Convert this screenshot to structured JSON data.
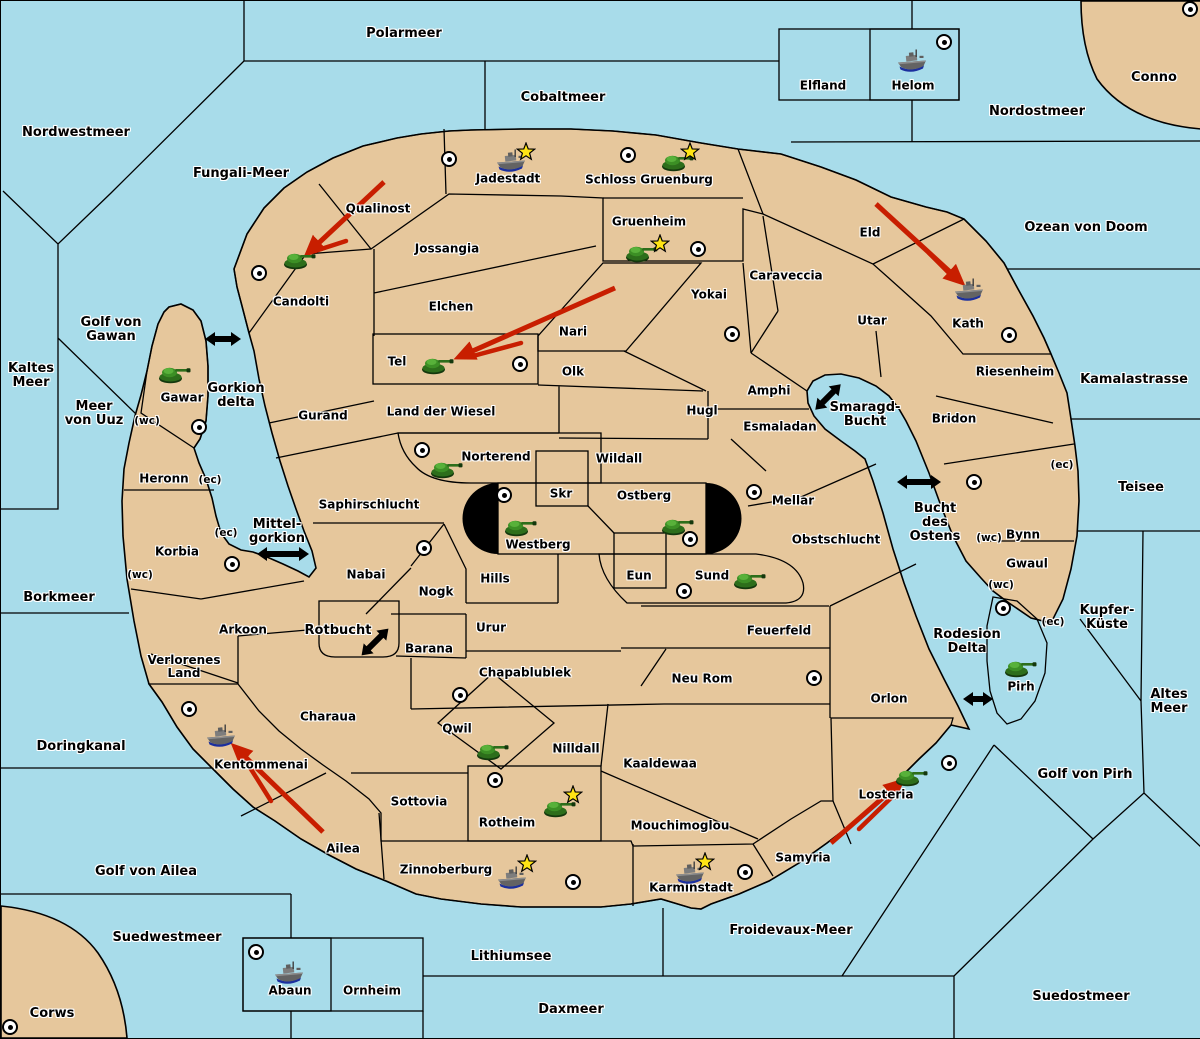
{
  "title": "Fantasy conquest map",
  "colors": {
    "sea": "#a8dcea",
    "land": "#e6c79c",
    "green": "#a3c49a",
    "red": "#c0897f",
    "gray": "#8b8b8b",
    "black_zone": "#000000",
    "arrow_red": "#c81e00",
    "star": "#ffe414"
  },
  "sea_zones": [
    {
      "name": "Polarmeer",
      "x": 403,
      "y": 33
    },
    {
      "name": "Nordwestmeer",
      "x": 75,
      "y": 132
    },
    {
      "name": "Fungali-Meer",
      "x": 240,
      "y": 173
    },
    {
      "name": "Cobaltmeer",
      "x": 562,
      "y": 97
    },
    {
      "name": "Nordostmeer",
      "x": 1036,
      "y": 111
    },
    {
      "name": "Ozean von Doom",
      "x": 1085,
      "y": 227
    },
    {
      "name": "Kaltes\nMeer",
      "x": 30,
      "y": 375
    },
    {
      "name": "Golf von\nGawan",
      "x": 110,
      "y": 329
    },
    {
      "name": "Meer\nvon Uuz",
      "x": 93,
      "y": 413
    },
    {
      "name": "Gorkion\ndelta",
      "x": 235,
      "y": 395
    },
    {
      "name": "Mittel-\ngorkion",
      "x": 276,
      "y": 531
    },
    {
      "name": "Borkmeer",
      "x": 58,
      "y": 597
    },
    {
      "name": "Doringkanal",
      "x": 80,
      "y": 746
    },
    {
      "name": "Golf von Ailea",
      "x": 145,
      "y": 871
    },
    {
      "name": "Suedwestmeer",
      "x": 166,
      "y": 937
    },
    {
      "name": "Corws",
      "x": 51,
      "y": 1013
    },
    {
      "name": "Lithiumsee",
      "x": 510,
      "y": 956
    },
    {
      "name": "Daxmeer",
      "x": 570,
      "y": 1009
    },
    {
      "name": "Froidevaux-Meer",
      "x": 790,
      "y": 930
    },
    {
      "name": "Suedostmeer",
      "x": 1080,
      "y": 996
    },
    {
      "name": "Golf von Pirh",
      "x": 1084,
      "y": 774
    },
    {
      "name": "Altes\nMeer",
      "x": 1168,
      "y": 701
    },
    {
      "name": "Kupfer-\nKüste",
      "x": 1106,
      "y": 617
    },
    {
      "name": "Teisee",
      "x": 1140,
      "y": 487
    },
    {
      "name": "Kamalastrasse",
      "x": 1133,
      "y": 379
    },
    {
      "name": "Conno",
      "x": 1153,
      "y": 77
    },
    {
      "name": "Rotbucht",
      "x": 337,
      "y": 630
    },
    {
      "name": "Smaragd-\nBucht",
      "x": 864,
      "y": 414
    },
    {
      "name": "Bucht\ndes\nOstens",
      "x": 934,
      "y": 522
    },
    {
      "name": "Rodesion\nDelta",
      "x": 966,
      "y": 641
    }
  ],
  "territories": [
    {
      "name": "Jadestadt",
      "x": 507,
      "y": 178
    },
    {
      "name": "Schloss Gruenburg",
      "x": 648,
      "y": 179
    },
    {
      "name": "Gruenheim",
      "x": 648,
      "y": 221
    },
    {
      "name": "Qualinost",
      "x": 377,
      "y": 208
    },
    {
      "name": "Candolti",
      "x": 300,
      "y": 301
    },
    {
      "name": "Jossangia",
      "x": 446,
      "y": 248
    },
    {
      "name": "Elchen",
      "x": 450,
      "y": 306
    },
    {
      "name": "Nari",
      "x": 572,
      "y": 331
    },
    {
      "name": "Tel",
      "x": 396,
      "y": 361
    },
    {
      "name": "Olk",
      "x": 572,
      "y": 371
    },
    {
      "name": "Yokai",
      "x": 708,
      "y": 294
    },
    {
      "name": "Eld",
      "x": 869,
      "y": 232
    },
    {
      "name": "Caraveccia",
      "x": 785,
      "y": 275
    },
    {
      "name": "Utar",
      "x": 871,
      "y": 320
    },
    {
      "name": "Kath",
      "x": 967,
      "y": 323
    },
    {
      "name": "Riesenheim",
      "x": 1014,
      "y": 371
    },
    {
      "name": "Bridon",
      "x": 953,
      "y": 418
    },
    {
      "name": "Gurand",
      "x": 322,
      "y": 415
    },
    {
      "name": "Land der Wiesel",
      "x": 440,
      "y": 411
    },
    {
      "name": "Hugl",
      "x": 701,
      "y": 410
    },
    {
      "name": "Amphi",
      "x": 768,
      "y": 390
    },
    {
      "name": "Esmaladan",
      "x": 779,
      "y": 426
    },
    {
      "name": "Norterend",
      "x": 495,
      "y": 456
    },
    {
      "name": "Wildall",
      "x": 618,
      "y": 458
    },
    {
      "name": "Skr",
      "x": 560,
      "y": 493
    },
    {
      "name": "Ostberg",
      "x": 643,
      "y": 495
    },
    {
      "name": "Westberg",
      "x": 537,
      "y": 544
    },
    {
      "name": "Mellar",
      "x": 792,
      "y": 500
    },
    {
      "name": "Obstschlucht",
      "x": 835,
      "y": 539
    },
    {
      "name": "Eun",
      "x": 638,
      "y": 575
    },
    {
      "name": "Sund",
      "x": 711,
      "y": 575
    },
    {
      "name": "Hills",
      "x": 494,
      "y": 578
    },
    {
      "name": "Nogk",
      "x": 435,
      "y": 591
    },
    {
      "name": "Urur",
      "x": 490,
      "y": 627
    },
    {
      "name": "Saphirschlucht",
      "x": 368,
      "y": 504
    },
    {
      "name": "Nabai",
      "x": 365,
      "y": 574
    },
    {
      "name": "Barana",
      "x": 428,
      "y": 648
    },
    {
      "name": "Chapablublek",
      "x": 524,
      "y": 672
    },
    {
      "name": "Feuerfeld",
      "x": 778,
      "y": 630
    },
    {
      "name": "Neu Rom",
      "x": 701,
      "y": 678
    },
    {
      "name": "Orlon",
      "x": 888,
      "y": 698
    },
    {
      "name": "Arkoon",
      "x": 242,
      "y": 629
    },
    {
      "name": "Verlorenes\nLand",
      "x": 183,
      "y": 666
    },
    {
      "name": "Charaua",
      "x": 327,
      "y": 716
    },
    {
      "name": "Kentommenai",
      "x": 260,
      "y": 764
    },
    {
      "name": "Ailea",
      "x": 342,
      "y": 848
    },
    {
      "name": "Sottovia",
      "x": 418,
      "y": 801
    },
    {
      "name": "Qwil",
      "x": 456,
      "y": 728
    },
    {
      "name": "Nilldall",
      "x": 575,
      "y": 748
    },
    {
      "name": "Kaaldewaa",
      "x": 659,
      "y": 763
    },
    {
      "name": "Rotheim",
      "x": 506,
      "y": 822
    },
    {
      "name": "Mouchimoglou",
      "x": 679,
      "y": 825
    },
    {
      "name": "Zinnoberburg",
      "x": 445,
      "y": 869
    },
    {
      "name": "Karminstadt",
      "x": 690,
      "y": 887
    },
    {
      "name": "Samyria",
      "x": 802,
      "y": 857
    },
    {
      "name": "Losteria",
      "x": 885,
      "y": 794
    },
    {
      "name": "Gawar",
      "x": 181,
      "y": 397
    },
    {
      "name": "Heronn",
      "x": 163,
      "y": 478
    },
    {
      "name": "Korbia",
      "x": 176,
      "y": 551
    },
    {
      "name": "Bynn",
      "x": 1022,
      "y": 534
    },
    {
      "name": "Gwaul",
      "x": 1026,
      "y": 563
    },
    {
      "name": "Pirh",
      "x": 1020,
      "y": 686
    },
    {
      "name": "Elfland",
      "x": 822,
      "y": 85
    },
    {
      "name": "Helom",
      "x": 912,
      "y": 85
    },
    {
      "name": "Abaun",
      "x": 289,
      "y": 990
    },
    {
      "name": "Ornheim",
      "x": 371,
      "y": 990
    }
  ],
  "port_markers": [
    {
      "label": "(wc)",
      "x": 146,
      "y": 420
    },
    {
      "label": "(ec)",
      "x": 209,
      "y": 479
    },
    {
      "label": "(ec)",
      "x": 225,
      "y": 532
    },
    {
      "label": "(wc)",
      "x": 139,
      "y": 574
    },
    {
      "label": "(ec)",
      "x": 1061,
      "y": 464
    },
    {
      "label": "(wc)",
      "x": 988,
      "y": 537
    },
    {
      "label": "(wc)",
      "x": 1000,
      "y": 584
    },
    {
      "label": "(ec)",
      "x": 1052,
      "y": 621
    }
  ],
  "capitals": [
    {
      "territory": "Jadestadt",
      "x": 448,
      "y": 158
    },
    {
      "territory": "Schloss Gruenburg",
      "x": 627,
      "y": 154
    },
    {
      "territory": "Gruenheim",
      "x": 697,
      "y": 248
    },
    {
      "territory": "Candolti",
      "x": 258,
      "y": 272
    },
    {
      "territory": "Conno",
      "x": 1189,
      "y": 8
    },
    {
      "territory": "Helom",
      "x": 943,
      "y": 41
    },
    {
      "territory": "Kath",
      "x": 1008,
      "y": 334
    },
    {
      "territory": "Yokai",
      "x": 731,
      "y": 333
    },
    {
      "territory": "Tel",
      "x": 519,
      "y": 363
    },
    {
      "territory": "Gawar",
      "x": 198,
      "y": 426
    },
    {
      "territory": "Norterend",
      "x": 421,
      "y": 449
    },
    {
      "territory": "Westberg",
      "x": 503,
      "y": 494
    },
    {
      "territory": "Ostberg",
      "x": 689,
      "y": 538
    },
    {
      "territory": "Mellar",
      "x": 753,
      "y": 491
    },
    {
      "territory": "Sund",
      "x": 683,
      "y": 590
    },
    {
      "territory": "Nabai",
      "x": 423,
      "y": 547
    },
    {
      "territory": "Korbia",
      "x": 231,
      "y": 563
    },
    {
      "territory": "Bynn",
      "x": 973,
      "y": 481
    },
    {
      "territory": "Pirh",
      "x": 1002,
      "y": 607
    },
    {
      "territory": "Neu Rom",
      "x": 813,
      "y": 677
    },
    {
      "territory": "Qwil",
      "x": 459,
      "y": 694
    },
    {
      "territory": "Rotheim",
      "x": 494,
      "y": 779
    },
    {
      "territory": "Zinnoberburg",
      "x": 572,
      "y": 881
    },
    {
      "territory": "Karminstadt",
      "x": 744,
      "y": 871
    },
    {
      "territory": "Kentommenai",
      "x": 188,
      "y": 708
    },
    {
      "territory": "Losteria",
      "x": 948,
      "y": 762
    },
    {
      "territory": "Corws",
      "x": 9,
      "y": 1026
    },
    {
      "territory": "Abaun",
      "x": 255,
      "y": 951
    }
  ],
  "units": [
    {
      "type": "tank",
      "territory": "Candolti",
      "x": 298,
      "y": 258
    },
    {
      "type": "tank",
      "territory": "Schloss Gruenburg",
      "x": 676,
      "y": 160
    },
    {
      "type": "tank",
      "territory": "Gruenheim",
      "x": 640,
      "y": 251
    },
    {
      "type": "tank",
      "territory": "Tel",
      "x": 436,
      "y": 363
    },
    {
      "type": "tank",
      "territory": "Gawar",
      "x": 173,
      "y": 372
    },
    {
      "type": "tank",
      "territory": "Norterend",
      "x": 445,
      "y": 467
    },
    {
      "type": "tank",
      "territory": "Westberg",
      "x": 519,
      "y": 525
    },
    {
      "type": "tank",
      "territory": "Ostberg",
      "x": 676,
      "y": 524
    },
    {
      "type": "tank",
      "territory": "Sund",
      "x": 748,
      "y": 578
    },
    {
      "type": "tank",
      "territory": "Pirh",
      "x": 1019,
      "y": 666
    },
    {
      "type": "tank",
      "territory": "Qwil",
      "x": 491,
      "y": 749
    },
    {
      "type": "tank",
      "territory": "Rotheim",
      "x": 558,
      "y": 806
    },
    {
      "type": "tank",
      "territory": "Losteria",
      "x": 910,
      "y": 775
    },
    {
      "type": "ship",
      "territory": "Jadestadt",
      "x": 510,
      "y": 160
    },
    {
      "type": "ship",
      "territory": "Kath",
      "x": 968,
      "y": 289
    },
    {
      "type": "ship",
      "territory": "Helom",
      "x": 911,
      "y": 60
    },
    {
      "type": "ship",
      "territory": "Kentommenai",
      "x": 220,
      "y": 735
    },
    {
      "type": "ship",
      "territory": "Zinnoberburg",
      "x": 511,
      "y": 877
    },
    {
      "type": "ship",
      "territory": "Karminstadt",
      "x": 689,
      "y": 872
    },
    {
      "type": "ship",
      "territory": "Abaun",
      "x": 288,
      "y": 972
    }
  ],
  "stars": [
    {
      "territory": "Jadestadt",
      "x": 525,
      "y": 151
    },
    {
      "territory": "Schloss Gruenburg",
      "x": 689,
      "y": 151
    },
    {
      "territory": "Gruenheim",
      "x": 659,
      "y": 243
    },
    {
      "territory": "Rotheim",
      "x": 572,
      "y": 794
    },
    {
      "territory": "Zinnoberburg",
      "x": 526,
      "y": 863
    },
    {
      "territory": "Karminstadt",
      "x": 704,
      "y": 861
    }
  ],
  "attack_arrows": [
    {
      "from": "Qualinost",
      "to": "Candolti",
      "x1": 383,
      "y1": 181,
      "x2": 307,
      "y2": 252,
      "s": [
        345,
        240,
        314,
        250
      ]
    },
    {
      "from": "Nari",
      "to": "Tel",
      "x1": 614,
      "y1": 287,
      "x2": 458,
      "y2": 356,
      "s": [
        520,
        342,
        472,
        355
      ]
    },
    {
      "from": "Eld",
      "to": "Kath",
      "x1": 875,
      "y1": 203,
      "x2": 960,
      "y2": 281,
      "s": [
        928,
        252,
        950,
        274
      ]
    },
    {
      "from": "Ailea",
      "to": "Kentommenai",
      "x1": 322,
      "y1": 831,
      "x2": 234,
      "y2": 746,
      "s": [
        270,
        800,
        243,
        757
      ]
    },
    {
      "from": "Samyria",
      "to": "Losteria",
      "x1": 830,
      "y1": 842,
      "x2": 900,
      "y2": 781,
      "s": [
        858,
        828,
        892,
        795
      ]
    }
  ],
  "connection_arrows": [
    {
      "x": 222,
      "y": 338,
      "angle": 0,
      "len": 36
    },
    {
      "x": 282,
      "y": 553,
      "angle": 0,
      "len": 52
    },
    {
      "x": 827,
      "y": 396,
      "angle": -45,
      "len": 36
    },
    {
      "x": 374,
      "y": 641,
      "angle": -45,
      "len": 38
    },
    {
      "x": 918,
      "y": 481,
      "angle": 0,
      "len": 44
    },
    {
      "x": 977,
      "y": 698,
      "angle": 0,
      "len": 30
    }
  ]
}
